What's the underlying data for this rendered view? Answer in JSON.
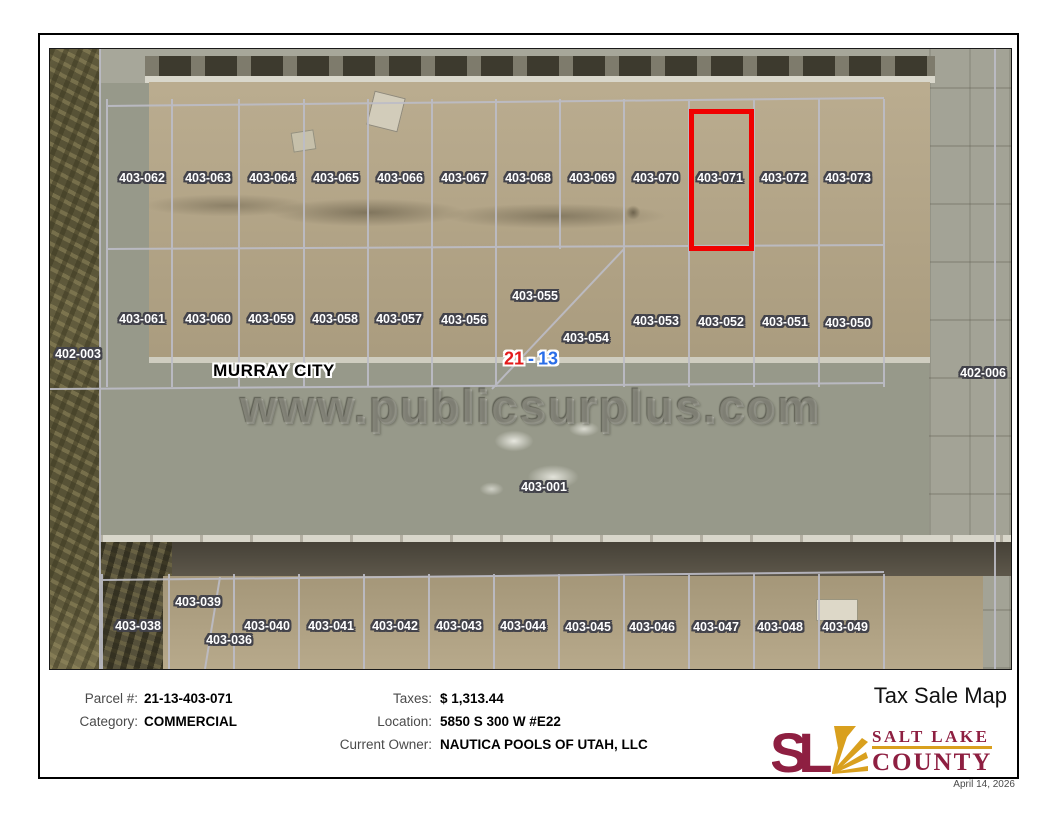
{
  "map": {
    "watermark": "www.publicsurplus.com",
    "city_label": "MURRAY CITY",
    "section": {
      "book": "21",
      "sep": "-",
      "page": "13"
    },
    "attribution": "Salt Lake County, Microsoft, Vantor",
    "highlighted_parcel": "403-071",
    "labels": [
      {
        "id": "403-062",
        "x": 92,
        "y": 129
      },
      {
        "id": "403-063",
        "x": 158,
        "y": 129
      },
      {
        "id": "403-064",
        "x": 222,
        "y": 129
      },
      {
        "id": "403-065",
        "x": 286,
        "y": 129
      },
      {
        "id": "403-066",
        "x": 350,
        "y": 129
      },
      {
        "id": "403-067",
        "x": 414,
        "y": 129
      },
      {
        "id": "403-068",
        "x": 478,
        "y": 129
      },
      {
        "id": "403-069",
        "x": 542,
        "y": 129
      },
      {
        "id": "403-070",
        "x": 606,
        "y": 129
      },
      {
        "id": "403-071",
        "x": 670,
        "y": 129
      },
      {
        "id": "403-072",
        "x": 734,
        "y": 129
      },
      {
        "id": "403-073",
        "x": 798,
        "y": 129
      },
      {
        "id": "403-061",
        "x": 92,
        "y": 270
      },
      {
        "id": "403-060",
        "x": 158,
        "y": 270
      },
      {
        "id": "403-059",
        "x": 221,
        "y": 270
      },
      {
        "id": "403-058",
        "x": 285,
        "y": 270
      },
      {
        "id": "403-057",
        "x": 349,
        "y": 270
      },
      {
        "id": "403-056",
        "x": 414,
        "y": 271
      },
      {
        "id": "403-055",
        "x": 485,
        "y": 247
      },
      {
        "id": "403-054",
        "x": 536,
        "y": 289
      },
      {
        "id": "403-053",
        "x": 606,
        "y": 272
      },
      {
        "id": "403-052",
        "x": 671,
        "y": 273
      },
      {
        "id": "403-051",
        "x": 735,
        "y": 273
      },
      {
        "id": "403-050",
        "x": 798,
        "y": 274
      },
      {
        "id": "402-003",
        "x": 28,
        "y": 305
      },
      {
        "id": "402-006",
        "x": 933,
        "y": 324
      },
      {
        "id": "403-001",
        "x": 494,
        "y": 438
      },
      {
        "id": "403-038",
        "x": 88,
        "y": 577
      },
      {
        "id": "403-039",
        "x": 148,
        "y": 553
      },
      {
        "id": "403-036",
        "x": 179,
        "y": 591
      },
      {
        "id": "403-040",
        "x": 217,
        "y": 577
      },
      {
        "id": "403-041",
        "x": 281,
        "y": 577
      },
      {
        "id": "403-042",
        "x": 345,
        "y": 577
      },
      {
        "id": "403-043",
        "x": 409,
        "y": 577
      },
      {
        "id": "403-044",
        "x": 473,
        "y": 577
      },
      {
        "id": "403-045",
        "x": 538,
        "y": 578
      },
      {
        "id": "403-046",
        "x": 602,
        "y": 578
      },
      {
        "id": "403-047",
        "x": 666,
        "y": 578
      },
      {
        "id": "403-048",
        "x": 730,
        "y": 578
      },
      {
        "id": "403-049",
        "x": 795,
        "y": 578
      }
    ]
  },
  "info": {
    "parcel_label": "Parcel #:",
    "parcel_value": "21-13-403-071",
    "category_label": "Category:",
    "category_value": "COMMERCIAL",
    "taxes_label": "Taxes:",
    "taxes_value": "$ 1,313.44",
    "location_label": "Location:",
    "location_value": "5850 S 300 W #E22",
    "owner_label": "Current Owner:",
    "owner_value": "NAUTICA POOLS OF UTAH, LLC",
    "title": "Tax Sale Map",
    "date": "April 14, 2026",
    "logo": {
      "mark": "SL",
      "line1": "SALT LAKE",
      "line2": "COUNTY"
    }
  },
  "colors": {
    "highlight_red": "#f00000",
    "section_book_red": "#e31b1b",
    "section_page_blue": "#2a6ee8",
    "logo_maroon": "#8e1f41",
    "logo_gold": "#d9a01e"
  }
}
